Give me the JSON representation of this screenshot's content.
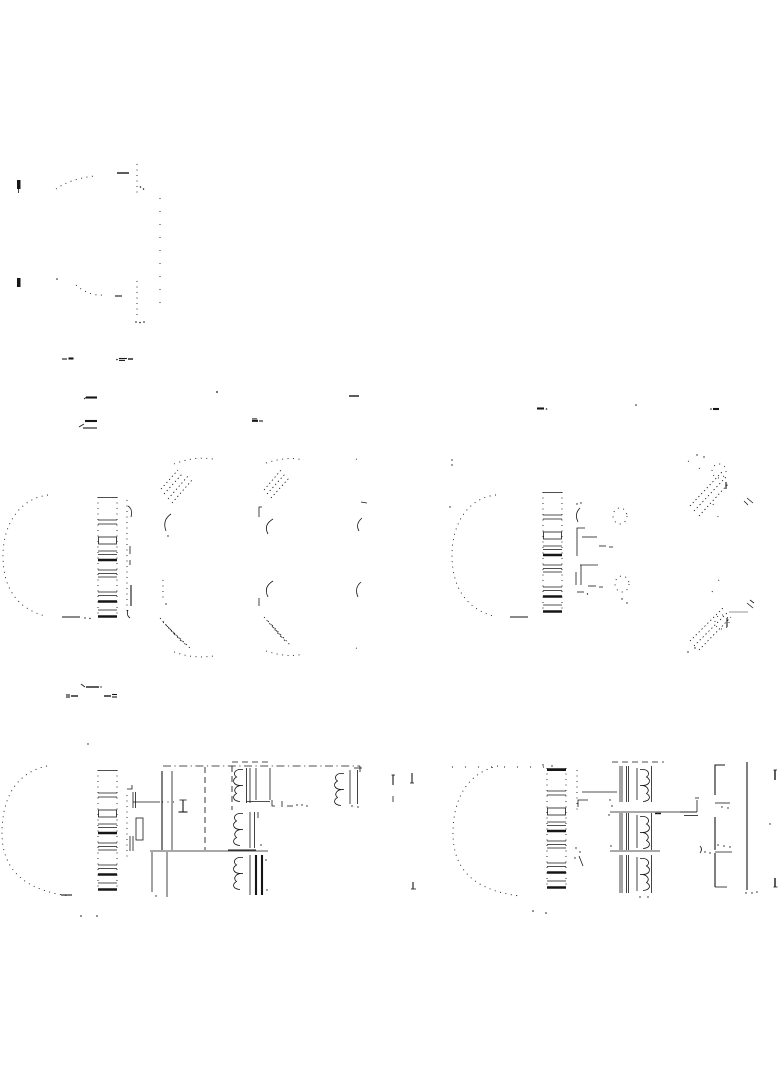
{
  "page": {
    "background": "#ffffff",
    "ink": "#161616",
    "gray_ink": "#ababab",
    "sheet_width": 784,
    "sheet_height": 1066,
    "content_kind": "faint technical line drawing, multiple figures, no legible text"
  },
  "figures": [
    {
      "id": "profile-view",
      "label": "dotted side-profile outline figure, upper left"
    },
    {
      "id": "exploded-left",
      "label": "left exploded view: open arc shell, slatted grille stack, two lens-shaped plates with corner hatching"
    },
    {
      "id": "exploded-right",
      "label": "right exploded view: open arc shell, slatted grille stack, small fastener hardware, hatched pin details"
    },
    {
      "id": "section-left",
      "label": "left cross-section schematic: arc shell, slat stack, dashed housing box, three coil-and-bar units plus one outboard unit"
    },
    {
      "id": "section-right",
      "label": "right cross-section schematic (mirrored): arc shell, slat stack, coil-and-bar units, bracket column and long wall line"
    }
  ],
  "annotations": {
    "caption_marks_legible": false,
    "caption_marks_appearance": "tiny dash / equals-shaped tick marks near figures (degraded, unreadable)"
  }
}
